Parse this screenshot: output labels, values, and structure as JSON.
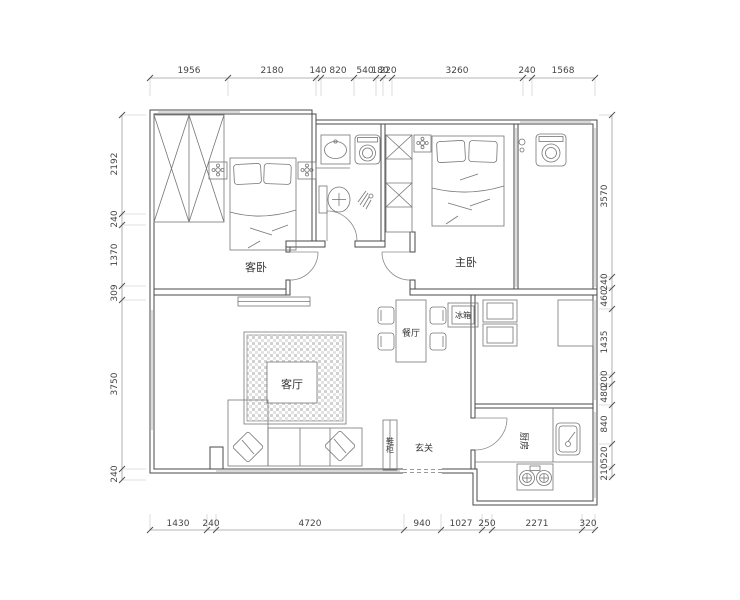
{
  "rooms": {
    "guest_bedroom": "客卧",
    "master_bedroom": "主卧",
    "living_room": "客厅",
    "dining_room": "餐厅",
    "kitchen": "厨房",
    "foyer": "玄关",
    "fridge": "冰箱",
    "shoe_cabinet": "鞋柜"
  },
  "dims": {
    "top": [
      "1956",
      "2180",
      "140",
      "820",
      "540",
      "180",
      "220",
      "3260",
      "240",
      "1568"
    ],
    "bottom": [
      "1430",
      "240",
      "4720",
      "940",
      "1027",
      "250",
      "2271",
      "320"
    ],
    "left": [
      "2192",
      "240",
      "1370",
      "309",
      "3750",
      "240"
    ],
    "right": [
      "3570",
      "240",
      "460",
      "1435",
      "200",
      "480",
      "840",
      "520",
      "210"
    ]
  },
  "colors": {
    "background": "#ffffff",
    "wall_line": "#4a4a4a",
    "furniture_line": "#767676",
    "dimension_text": "#454545",
    "rug_hatch": "#cfcfcf"
  }
}
